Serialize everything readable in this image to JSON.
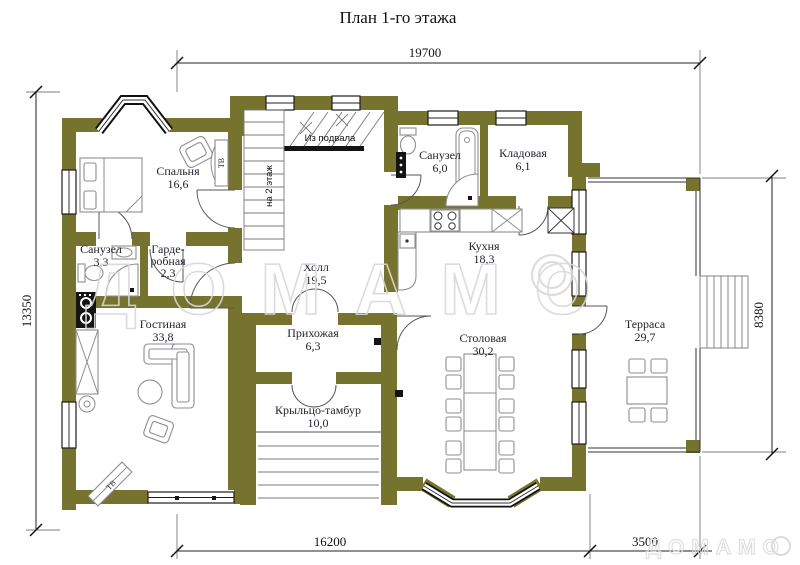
{
  "title": "План 1-го этажа",
  "dimensions": {
    "top": "19700",
    "left": "13350",
    "right": "8380",
    "bottom_main": "16200",
    "bottom_terrace": "3500"
  },
  "rooms": {
    "bedroom": {
      "name": "Спальня",
      "area": "16,6"
    },
    "bathroom_small": {
      "name": "Санузел",
      "area": "3,3"
    },
    "wardrobe": {
      "line1": "Гарде-",
      "line2": "робная",
      "area": "2,3"
    },
    "living": {
      "name": "Гостиная",
      "area": "33,8"
    },
    "hall": {
      "name": "Холл",
      "area": "19,5"
    },
    "hallway": {
      "name": "Прихожая",
      "area": "6,3"
    },
    "porch": {
      "name": "Крыльцо-тамбур",
      "area": "10,0"
    },
    "bathroom": {
      "name": "Санузел",
      "area": "6,0"
    },
    "storage": {
      "name": "Кладовая",
      "area": "6,1"
    },
    "kitchen": {
      "name": "Кухня",
      "area": "18,3"
    },
    "dining": {
      "name": "Столовая",
      "area": "30,2"
    },
    "terrace": {
      "name": "Терраса",
      "area": "29,7"
    }
  },
  "annotations": {
    "from_basement": "Из подвала",
    "to_second_floor": "на 2 этаж",
    "tv_bedroom": "ТВ",
    "tv_living": "ТВ"
  },
  "watermark": {
    "main": "ДОМАМО",
    "corner": "ДОМАМО"
  },
  "colors": {
    "wall": "#76732E",
    "line": "#1d1d1d",
    "furniture": "#8e8e8e",
    "watermark": "#d8d8d8"
  }
}
